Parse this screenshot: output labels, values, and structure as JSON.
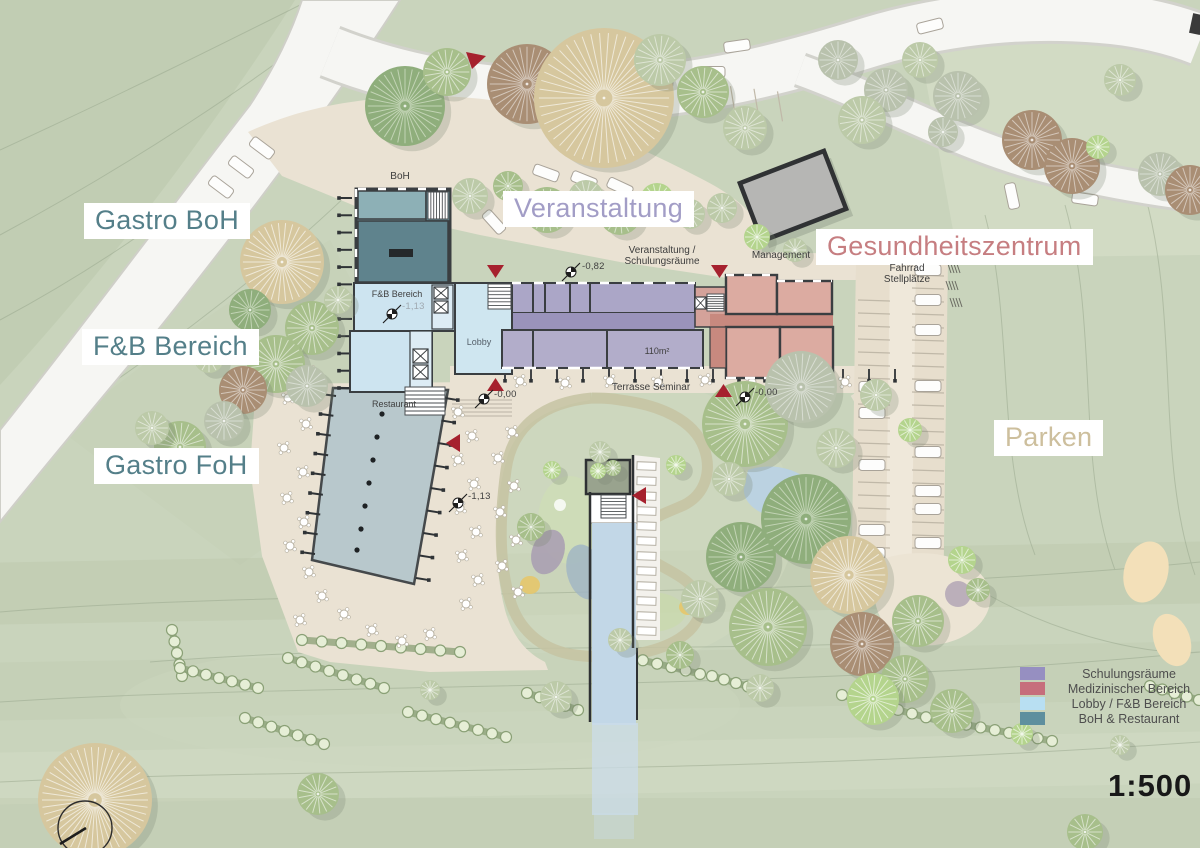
{
  "labels": {
    "gastro_boh": "Gastro BoH",
    "fb_bereich_big": "F&B Bereich",
    "gastro_foh": "Gastro FoH",
    "veranstaltung": "Veranstaltung",
    "gesundheitszentrum": "Gesundheitszentrum",
    "parken": "Parken"
  },
  "annotations": {
    "boh": "BoH",
    "management": "Management",
    "veranstaltung_schulung_line1": "Veranstaltung /",
    "veranstaltung_schulung_line2": "Schulungsräume",
    "fahrrad_line1": "Fahrrad",
    "fahrrad_line2": "Stellplätze",
    "fb_bereich_room": "F&B Bereich",
    "lobby": "Lobby",
    "room_area": "110m²",
    "terrasse_seminar": "Terrasse Seminar",
    "restaurant": "Restaurant"
  },
  "elevations": {
    "e_082": "-0,82",
    "e_113_fb": "-1,13",
    "e_000_left": "-0,00",
    "e_000_right": "-0,00",
    "e_113_terrace": "-1,13"
  },
  "legend": {
    "items": [
      {
        "label": "Schulungsräume",
        "color": "#968fc1"
      },
      {
        "label": "Medizinischer Bereich",
        "color": "#c66e7c"
      },
      {
        "label": "Lobby / F&B Bereich",
        "color": "#b8dff2"
      },
      {
        "label": "BoH & Restaurant",
        "color": "#5e8f9e"
      }
    ]
  },
  "scale": {
    "text": "1:500"
  },
  "colors": {
    "schulungsraeume_fill": "#aba6c7",
    "medizinischer_fill": "#dcaba1",
    "lobby_fb_fill": "#cfe6f0",
    "boh_restaurant_fill": "#5f838d",
    "marker_red": "#a6212e",
    "label_teal": "#547f89",
    "label_lavender": "#a29dc6",
    "label_salmon": "#c67e81",
    "label_tan": "#cdbf9d"
  }
}
